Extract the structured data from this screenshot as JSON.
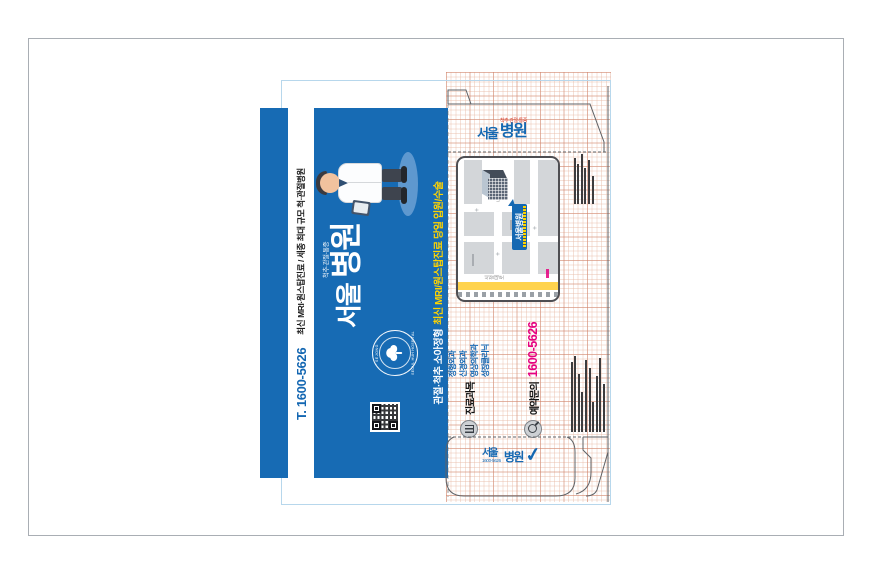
{
  "brand": {
    "monogram": "서울",
    "suffix": "병원",
    "full_name": "서울병원",
    "tagline_small": "척추·관절·통증",
    "phone_short": "1600-5626",
    "colors": {
      "blue": "#176bb4",
      "pink": "#e5007f",
      "yellow": "#ffd400",
      "red": "#d8402f"
    }
  },
  "blue_panel": {
    "strip": {
      "phone": "T. 1600-5626",
      "tagline": "최신 MRI·원스탑진료 / 세종 최대 규모 척·관절병원"
    },
    "bottom_line": {
      "white": "관절·척추 소아정형",
      "yellow": "최신 MRI/원스탑진료 당일 입원/수술"
    },
    "stamp": {
      "top_text": "· SEJONG ·",
      "bottom_text": "SEOUL HUH HOSPITAL"
    },
    "logo": {
      "monogram": "서울",
      "tagline": "척추·관절·통증",
      "suffix": "병원"
    }
  },
  "top_flap_logo": {
    "monogram": "서울",
    "tagline": "척추·관절·통증",
    "suffix": "병원"
  },
  "bottom_flap_logo": {
    "monogram": "서울",
    "suffix": "병원",
    "phone": "1600-5626",
    "check": "✓"
  },
  "face": {
    "clinic_section": {
      "label": "진료과목",
      "departments": [
        "정형외과",
        "신경외과",
        "영상의학과",
        "성장클리닉"
      ]
    },
    "booking_section": {
      "label": "예약문의",
      "phone": "1600-5626"
    }
  },
  "map": {
    "badge": "서울병원",
    "road_label_vertical": "시청대로",
    "road_label": "나성북로",
    "marker": "+"
  }
}
